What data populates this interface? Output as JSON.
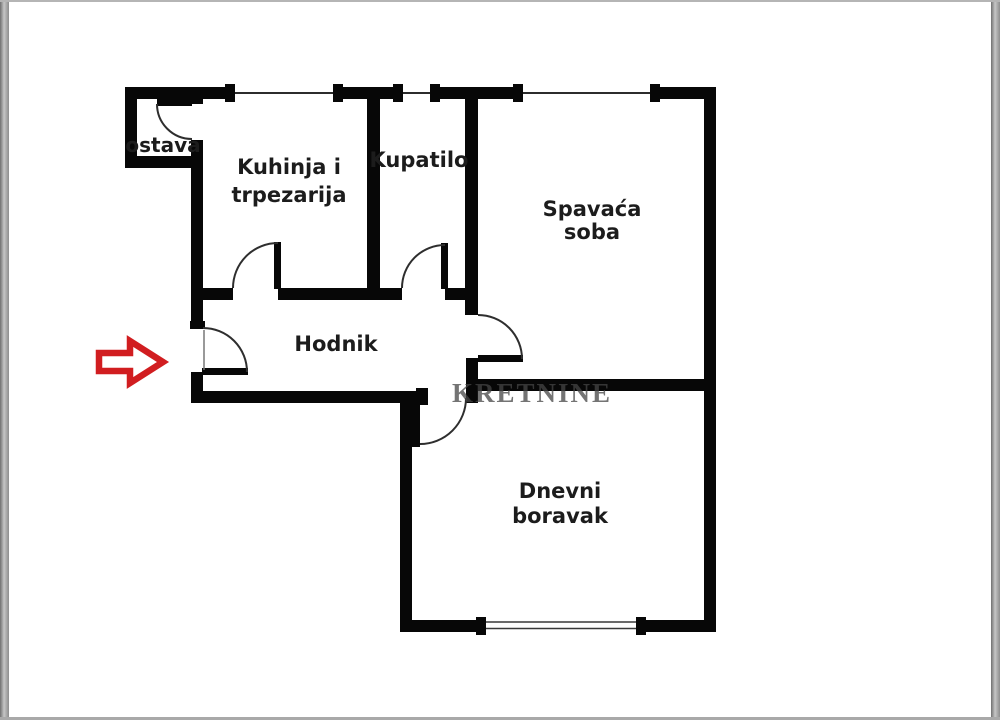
{
  "rooms": {
    "ostava": {
      "label": "ostava"
    },
    "kuhinja": {
      "line1": "Kuhinja i",
      "line2": "trpezarija"
    },
    "kupatilo": {
      "label": "Kupatilo"
    },
    "spavaca_soba": {
      "line1": "Spavaća",
      "line2": "soba"
    },
    "hodnik": {
      "label": "Hodnik"
    },
    "dnevni_boravak": {
      "line1": "Dnevni",
      "line2": "boravak"
    }
  },
  "watermark": {
    "text": "KRETNINE"
  },
  "entrance": {
    "icon": "arrow-right-icon"
  },
  "colors": {
    "wall": "#070707",
    "arrow": "#d11d20",
    "label": "#1c1c1c",
    "watermark": "rgba(70,70,70,0.75)"
  }
}
